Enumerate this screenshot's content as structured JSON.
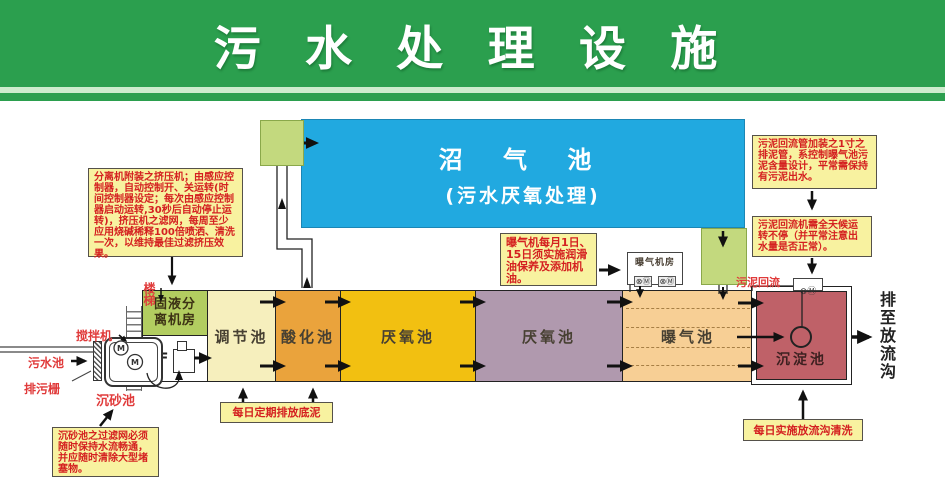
{
  "header": {
    "title": "污 水 处 理 设 施"
  },
  "biogas_tank": {
    "line1": "沼  气  池",
    "line2": "(污水厌氧处理)"
  },
  "tanks": {
    "separator_room": "固液分离机房",
    "floor": "2F",
    "regulating": "调节池",
    "acidification": "酸化池",
    "anaerobic1": "厌氧池",
    "anaerobic2": "厌氧池",
    "aeration": "曝气池",
    "sedimentation": "沉淀池"
  },
  "labels": {
    "stairs": "楼梯",
    "mixer": "搅拌机",
    "sewage_pool": "污水池",
    "trash_screen": "排污栅",
    "grit_chamber": "沉砂池",
    "sludge_return": "污泥回流",
    "aerator_room": "曝气机房",
    "aerator_motors": "⊗Ⓜ",
    "return_pump": "⊗Ⓜ",
    "motor": "M",
    "outflow": "排至放流沟"
  },
  "notes": {
    "press_machine": "分离机附装之挤压机；由感应控制器，自动控制开、关运转(时间控制器设定；每次由感应控制器启动运转,30秒后自动停止运转)，挤压机之滤网，每周至少应用烧碱稀释100倍喷洒、清洗一次，以维持最佳过滤挤压效果。",
    "sludge_pipe": "污泥回流管加装之1寸之排泥管，系控制曝气池污泥含量设计，平常需保持有污泥出水。",
    "sludge_pump": "污泥回流机需全天候运转不停（并平常注意出水量是否正常）。",
    "aerator_maintenance": "曝气机每月1日、15日须实施润滑油保养及添加机油。",
    "bottom_sludge": "每日定期排放底泥",
    "ditch_cleaning": "每日实施放流沟清洗",
    "grit_filter": "沉砂池之过滤网必须随时保持水流畅通，并应随时清除大型堵塞物。"
  },
  "colors": {
    "header_green": "#2b9f4e",
    "biogas_blue": "#21a9e0",
    "inlet_box_green": "#c3d97e",
    "separator_room_green": "#b2cd60",
    "regulating_yellow": "#f6efbd",
    "acidification_orange": "#eaa33c",
    "anaerobic1_gold": "#f2c011",
    "anaerobic2_mauve": "#b099ae",
    "aeration_peach": "#f7cf95",
    "sedimentation_red": "#bf6168",
    "note_yellow": "#f8f2a0",
    "red_text": "#d42020"
  }
}
